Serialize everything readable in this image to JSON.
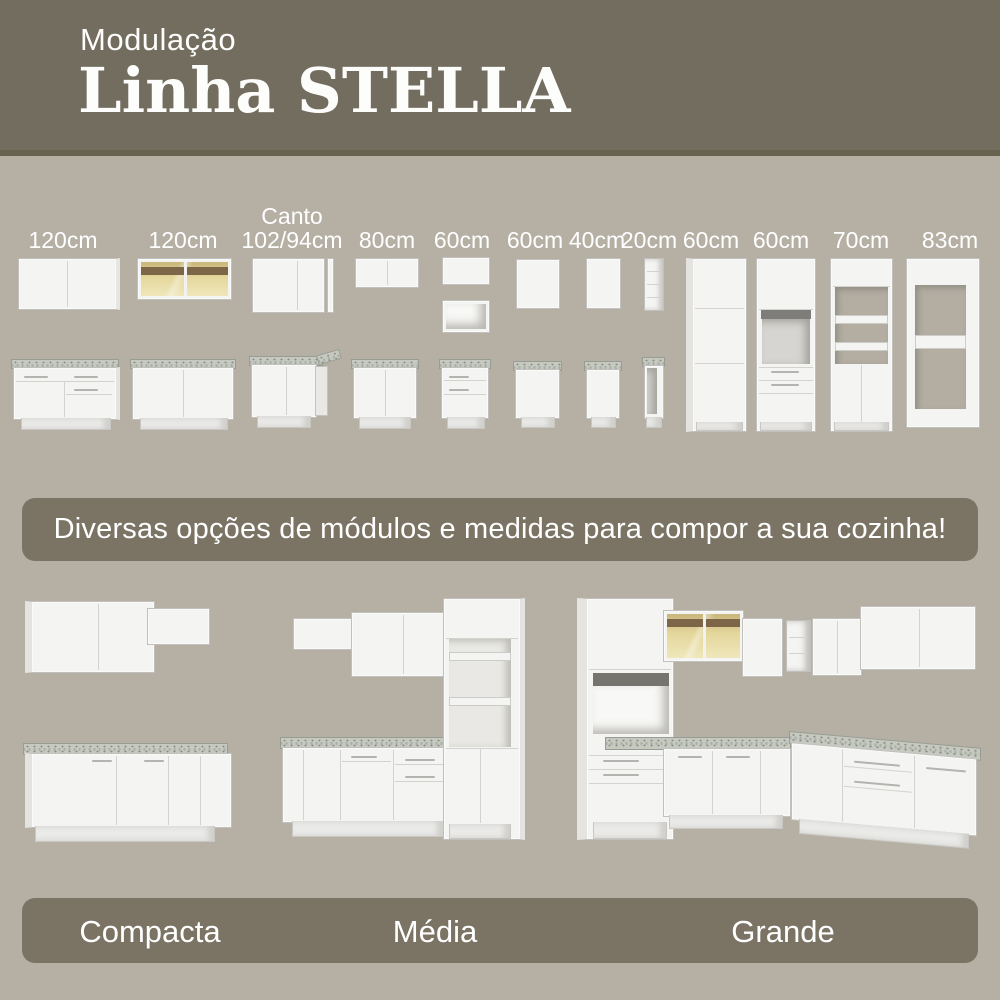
{
  "header": {
    "eyebrow": "Modulação",
    "title": "Linha STELLA"
  },
  "modules": [
    {
      "label": "120cm",
      "top": "wall-cabinet-two-doors",
      "bottom": "base-cabinet-drawers-and-doors"
    },
    {
      "label": "120cm",
      "top": "wall-cabinet-glass-doors-lit",
      "bottom": "base-cabinet-two-doors"
    },
    {
      "prefix": "Canto",
      "label": "102/94cm",
      "top": "corner-wall-cabinet",
      "bottom": "corner-base-cabinet"
    },
    {
      "label": "80cm",
      "top": "wall-cabinet-low",
      "bottom": "base-cabinet-two-doors"
    },
    {
      "label": "60cm",
      "top": "wall-cabinet-low-and-open-niche",
      "bottom": "base-cabinet-drawers"
    },
    {
      "label": "60cm",
      "top": "wall-cabinet-single-door",
      "bottom": "base-cabinet-single-door"
    },
    {
      "label": "40cm",
      "top": "wall-cabinet-narrow",
      "bottom": "base-cabinet-narrow"
    },
    {
      "label": "20cm",
      "top": "open-shelf-column",
      "bottom": "open-base-column"
    },
    {
      "label": "60cm",
      "top": "tall-pantry-cabinet"
    },
    {
      "label": "60cm",
      "top": "tall-oven-tower"
    },
    {
      "label": "70cm",
      "top": "tall-cabinet-open-shelves"
    },
    {
      "label": "83cm",
      "top": "tall-refrigerator-surround"
    }
  ],
  "banner": {
    "text": "Diversas opções de módulos e medidas para compor a sua cozinha!"
  },
  "layouts": [
    {
      "name": "Compacta"
    },
    {
      "name": "Média"
    },
    {
      "name": "Grande"
    }
  ],
  "colors": {
    "header_bg": "#736d5f",
    "header_divider": "#67624f",
    "body_bg": "#b5afa4",
    "band_bg": "#7b7465",
    "cabinet_white": "#f4f4f3",
    "countertop_gray": "#c6c9c0",
    "glass_amber": "#e4d79c",
    "glass_wood_band": "#7d6547"
  }
}
